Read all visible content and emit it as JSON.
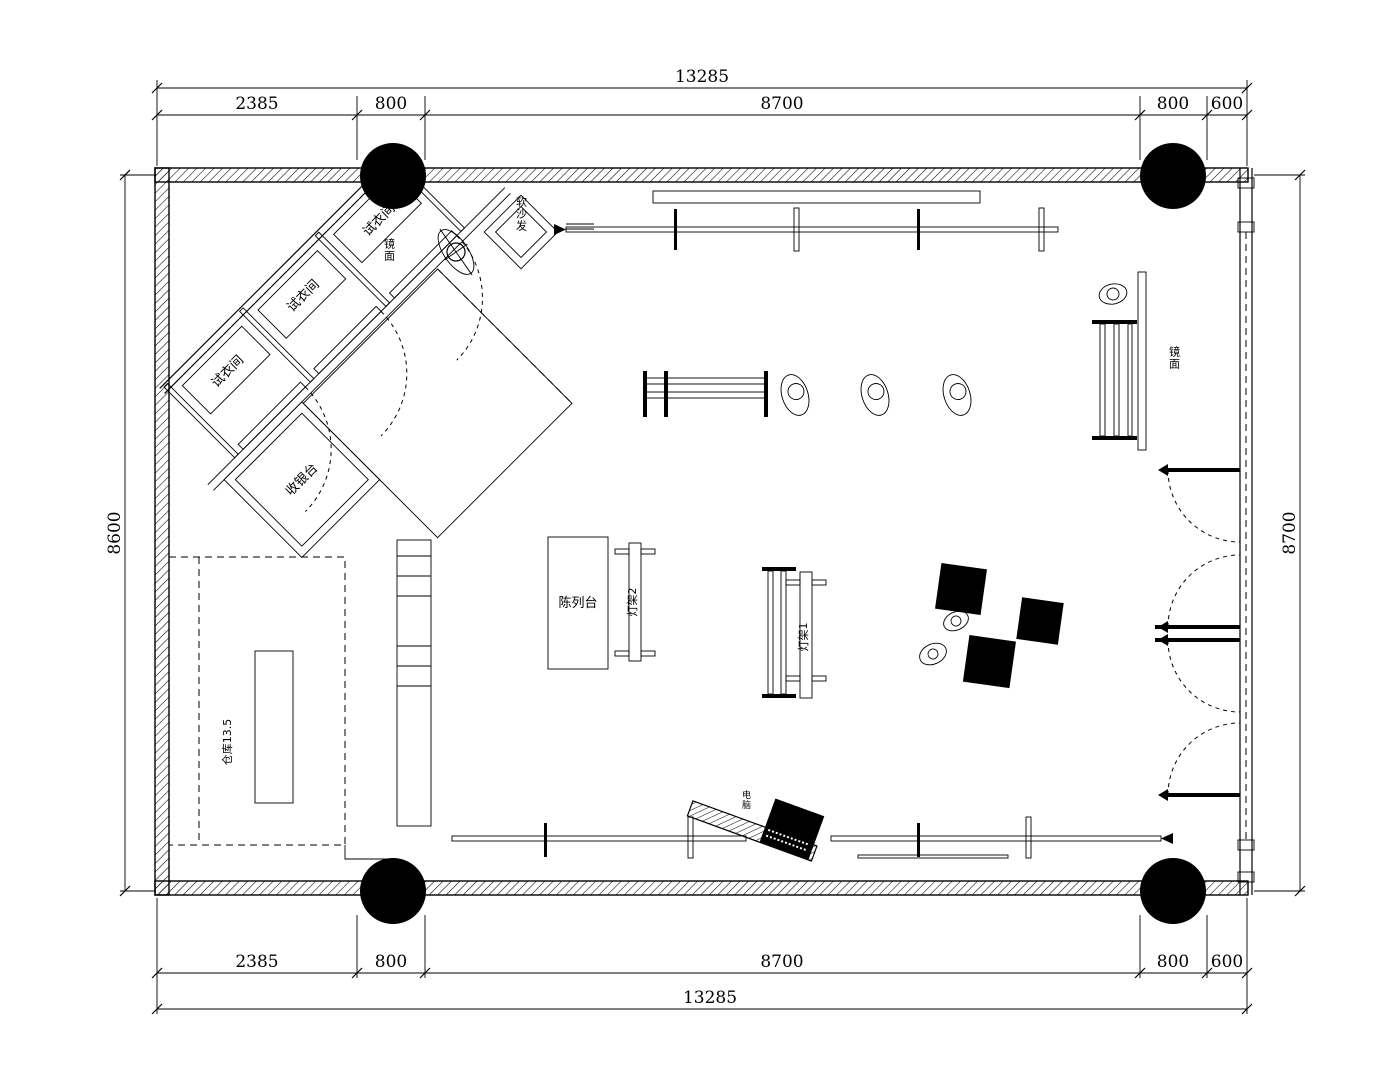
{
  "drawing": {
    "dimensions": {
      "top": {
        "overall": "13285",
        "segments": [
          "2385",
          "800",
          "8700",
          "800",
          "600"
        ]
      },
      "bottom": {
        "overall": "13285",
        "segments": [
          "2385",
          "800",
          "8700",
          "800",
          "600"
        ]
      },
      "left": "8600",
      "right": "8700"
    },
    "labels": {
      "fitting_room": "试衣间",
      "sofa": "软沙发",
      "mirror": "镜面",
      "cashier": "收银台",
      "warehouse": "仓库13.5",
      "display_table": "陈列台",
      "light_rack_1": "灯架1",
      "light_rack_2": "灯架2",
      "computer": "电脑"
    },
    "colors": {
      "line": "#000000",
      "bg": "#ffffff"
    }
  }
}
